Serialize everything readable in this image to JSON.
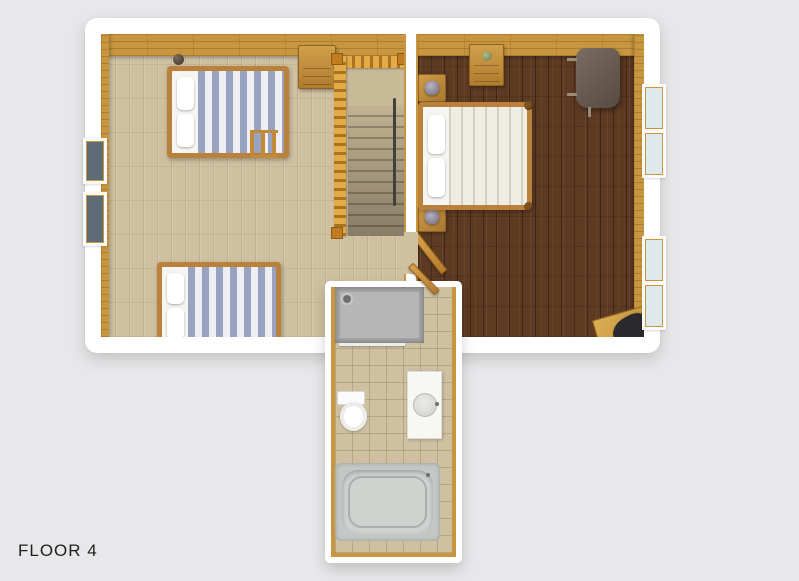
{
  "floor_label": "FLOOR 4",
  "plan": {
    "type": "3d-floor-plan-top-view",
    "rooms": [
      {
        "name": "bedroom-left",
        "floor": "light-oak-plank",
        "furniture": [
          "twin-bed-with-ladder",
          "twin-bed",
          "small-dresser",
          "decor-object",
          "staircase-with-railing"
        ],
        "windows_left_wall": 2
      },
      {
        "name": "bedroom-master",
        "floor": "dark-walnut-plank",
        "furniture": [
          "double-bed",
          "nightstand-with-lamp",
          "nightstand-with-lamp",
          "dresser-with-plant",
          "dark-round-table",
          "corner-desk",
          "office-chair"
        ],
        "windows_right_wall": 4,
        "doors": [
          "door-from-landing"
        ]
      },
      {
        "name": "bathroom",
        "floor": "beige-tile",
        "fixtures": [
          "shower-stall-with-glass",
          "toilet",
          "vanity-with-sink",
          "bathtub"
        ],
        "doors": [
          "door-from-master"
        ]
      }
    ],
    "stairs": {
      "direction": "down",
      "railing": "wood-balusters",
      "handrail": "dark"
    }
  },
  "colors": {
    "background": "#e8e8ea",
    "wall": "#ffffff",
    "floor_light": "#cfc1a0",
    "floor_dark": "#5d3a22",
    "wood": "#c8963f",
    "railing": "#e3ab45",
    "tile": "#cec0a1",
    "shower": "#a6a6a6",
    "tub": "#c3c8c5",
    "fixture": "#f7f7f4",
    "bed_stripe": "#98a3c0",
    "bed_stripe_alt": "#edeff4",
    "master_duvet": "#efece3",
    "master_stripe": "#d3cfc2",
    "table_dark": "#6b5d52",
    "chair": "#2b2b2e",
    "glass_light": "#dfe9ec",
    "glass_dark": "#5d6c75",
    "label": "#1f1f1f"
  }
}
